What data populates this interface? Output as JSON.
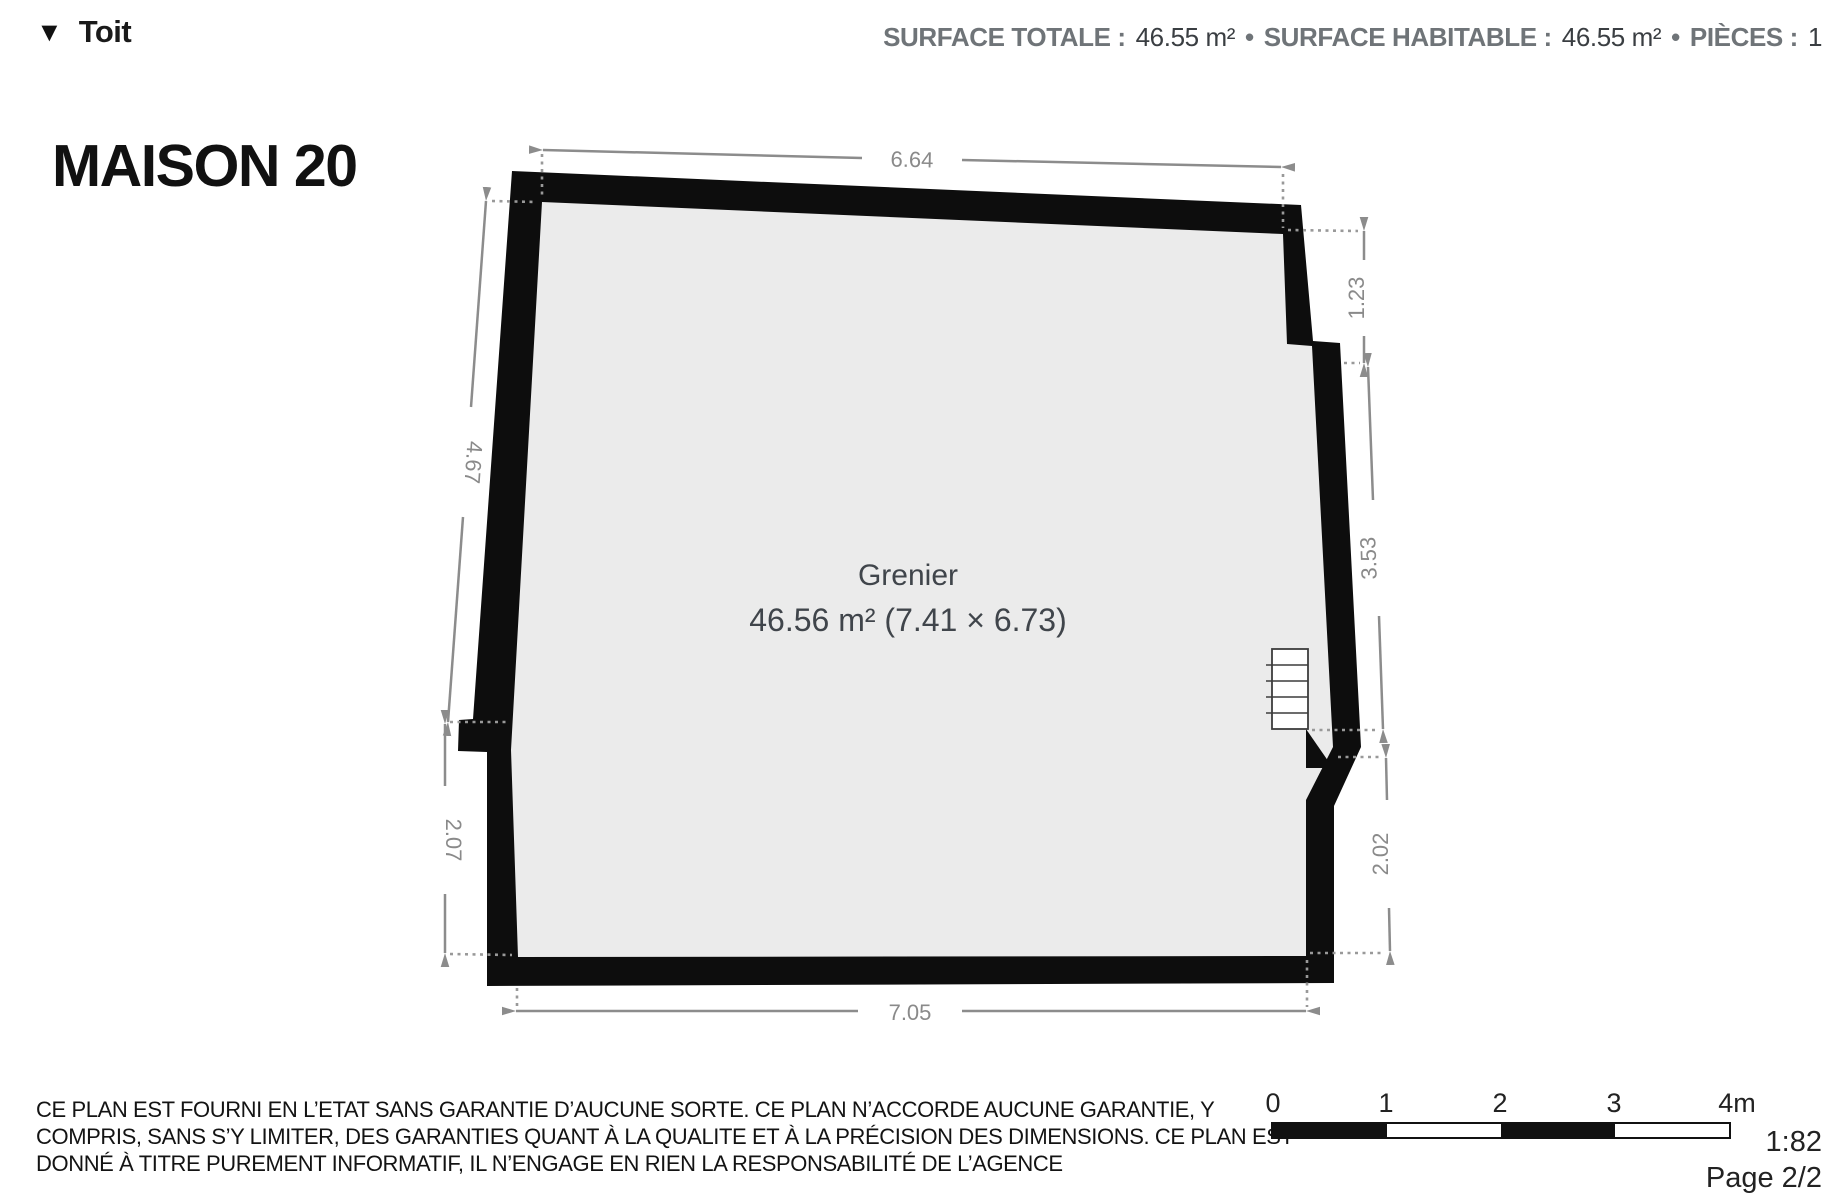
{
  "header": {
    "level_label": "Toit",
    "summary": {
      "surface_totale_label": "SURFACE TOTALE :",
      "surface_totale_value": "46.55 m²",
      "separator1": "•",
      "surface_habitable_label": "SURFACE HABITABLE :",
      "surface_habitable_value": "46.55 m²",
      "separator2": "•",
      "pieces_label": "PIÈCES :",
      "pieces_value": "1"
    }
  },
  "title": "MAISON 20",
  "plan": {
    "room": {
      "name": "Grenier",
      "area_text": "46.56 m² (7.41 × 6.73)"
    },
    "dimensions": {
      "top": "6.64",
      "left_upper": "4.67",
      "left_lower": "2.07",
      "bottom": "7.05",
      "right_upper": "1.23",
      "right_middle": "3.53",
      "right_lower": "2.02"
    }
  },
  "footer": {
    "disclaimer_lines": [
      "CE PLAN EST FOURNI EN L’ETAT SANS GARANTIE D’AUCUNE SORTE. CE PLAN N’ACCORDE AUCUNE GARANTIE, Y",
      "COMPRIS, SANS S’Y LIMITER, DES GARANTIES QUANT À LA QUALITE ET À LA PRÉCISION DES DIMENSIONS. CE PLAN EST",
      "DONNÉ À TITRE PUREMENT INFORMATIF, IL N’ENGAGE EN RIEN LA RESPONSABILITÉ DE L’AGENCE"
    ],
    "scale_bar": {
      "tick_labels": [
        "0",
        "1",
        "2",
        "3",
        "4m"
      ]
    },
    "scale_ratio": "1:82",
    "page": "Page 2/2"
  },
  "colors": {
    "wall": "#0d0d0d",
    "floor": "#ebebeb",
    "dimension": "#8c8c8c",
    "room_text": "#40454b"
  }
}
